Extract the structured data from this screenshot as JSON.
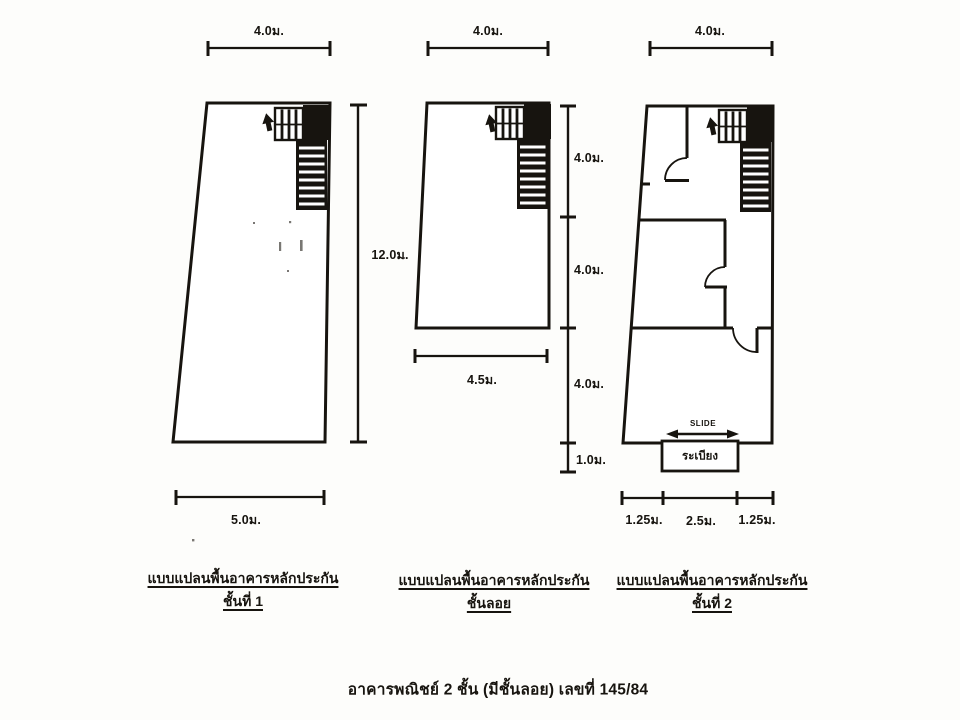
{
  "page": {
    "background": "#fdfdfb",
    "ink": "#17140f",
    "caption": "อาคารพณิชย์ 2 ชั้น (มีชั้นลอย) เลขที่ 145/84"
  },
  "plans": [
    {
      "name": "first-floor",
      "title": "แบบแปลนพื้นอาคารหลักประกัน",
      "subtitle": "ชั้นที่ 1",
      "dim_top": "4.0ม.",
      "dim_bottom": "5.0ม.",
      "dim_height": "12.0ม."
    },
    {
      "name": "mezzanine",
      "title": "แบบแปลนพื้นอาคารหลักประกัน",
      "subtitle": "ชั้นลอย",
      "dim_top": "4.0ม.",
      "dim_bottom": "4.5ม.",
      "right_dims": {
        "seg1": "4.0ม.",
        "seg2": "4.0ม.",
        "seg3": "4.0ม.",
        "seg4": "1.0ม."
      }
    },
    {
      "name": "second-floor",
      "title": "แบบแปลนพื้นอาคารหลักประกัน",
      "subtitle": "ชั้นที่ 2",
      "dim_top": "4.0ม.",
      "dim_bottom_left": "1.25ม.",
      "dim_bottom_mid": "2.5ม.",
      "dim_bottom_right": "1.25ม.",
      "slide_label": "SLIDE",
      "balcony_label": "ระเบียง"
    }
  ]
}
